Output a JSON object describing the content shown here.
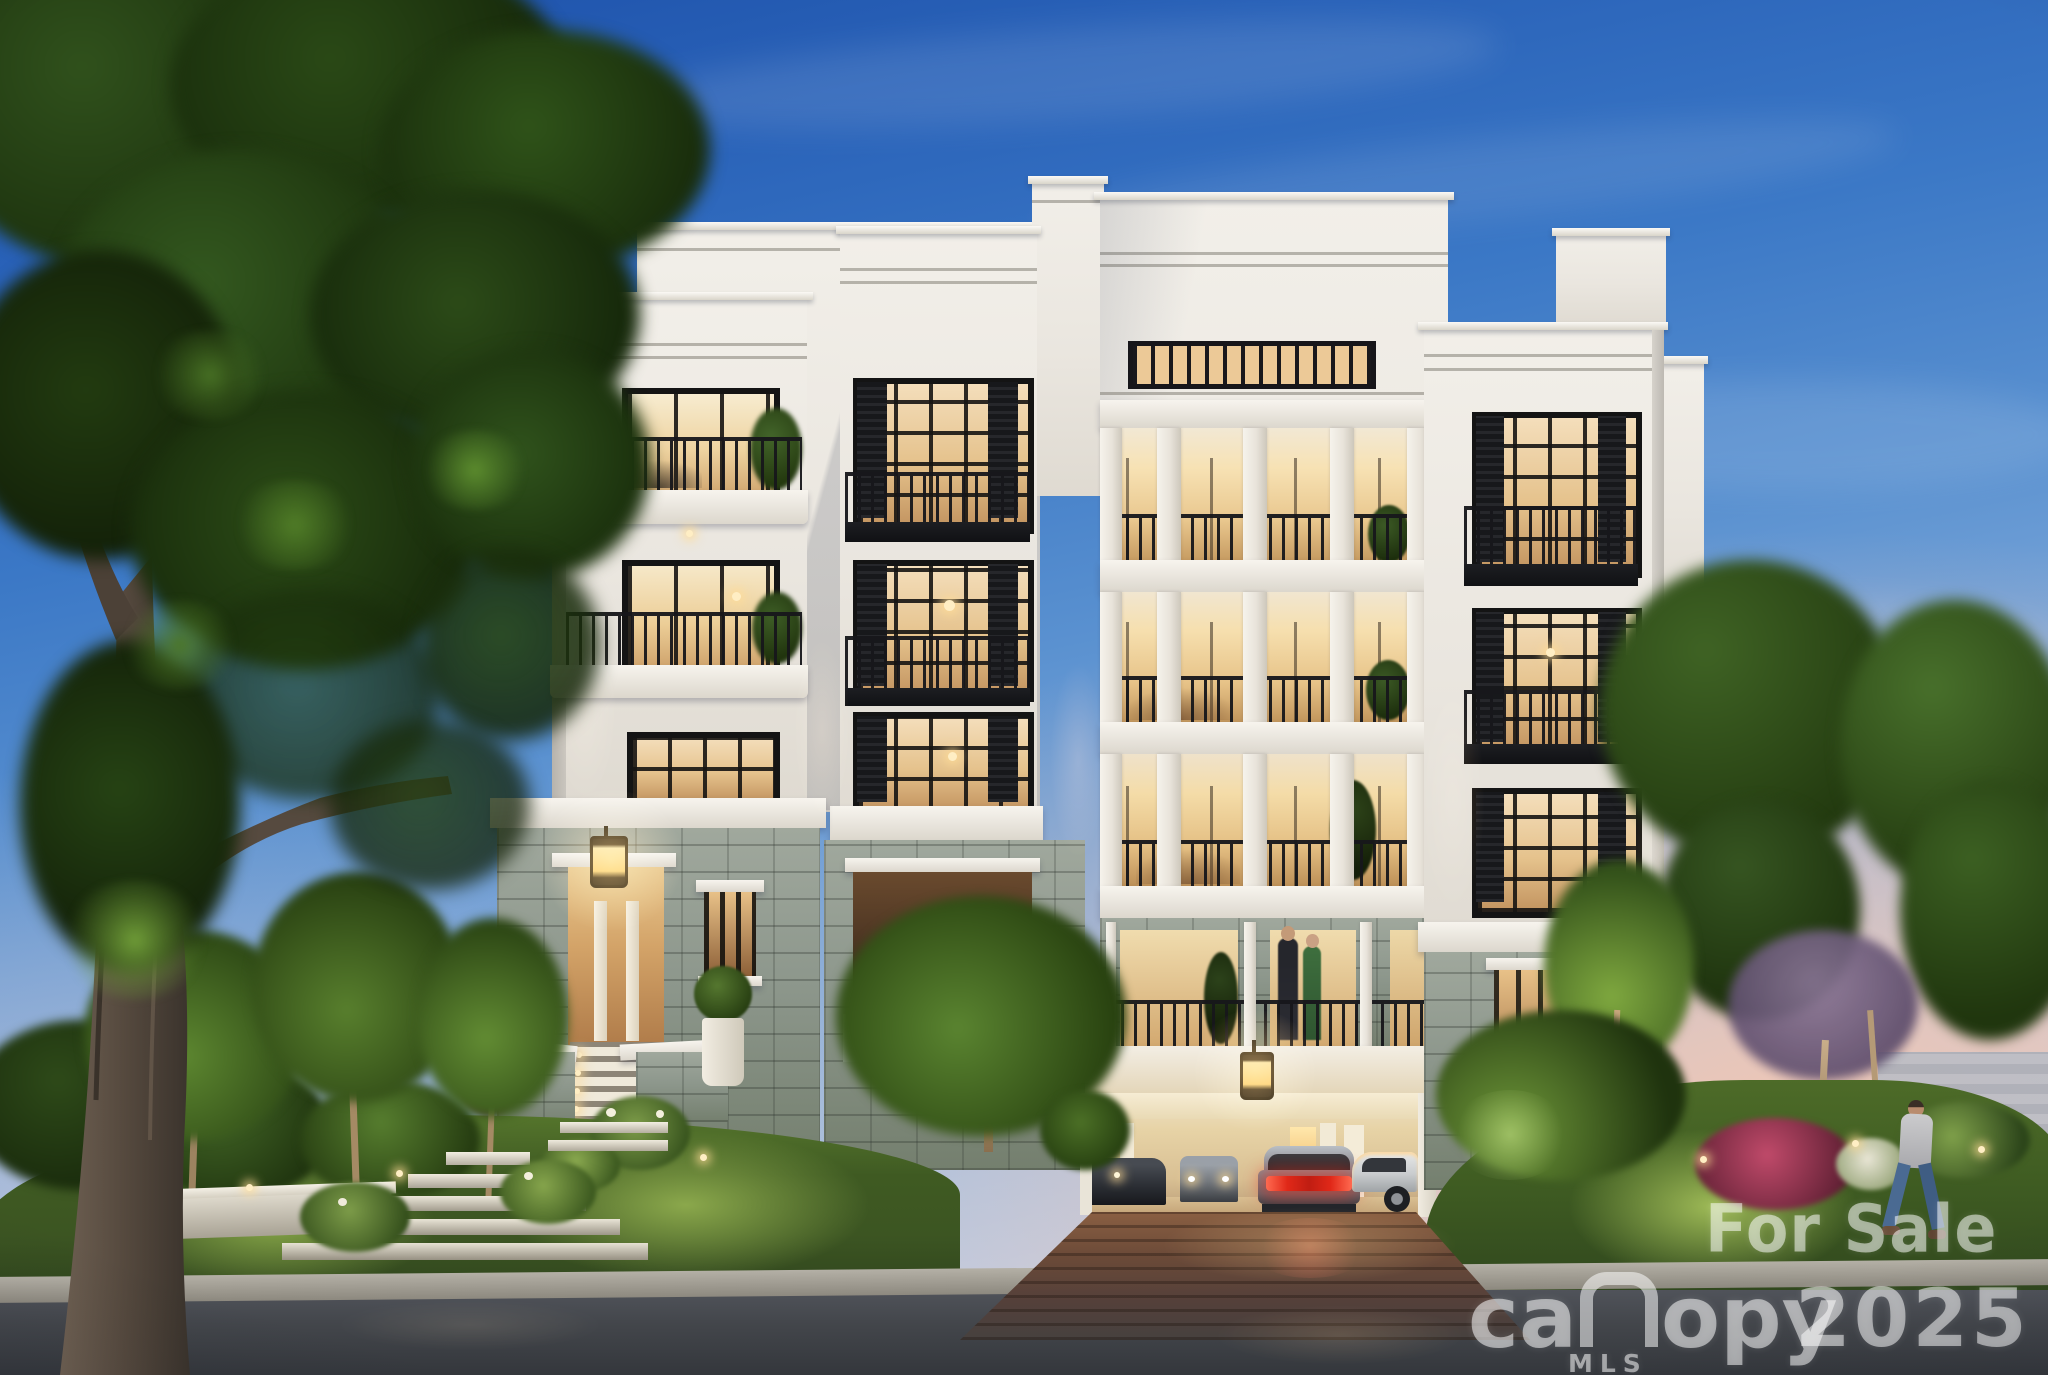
{
  "image": {
    "kind": "real-estate architectural rendering",
    "subject": "five-story white luxury condominium building at dusk with lit interiors",
    "orientation": "landscape"
  },
  "watermark": {
    "for_sale": "For Sale",
    "year": "2025",
    "brand": "canopy",
    "brand_prefix": "ca",
    "brand_suffix": "opy",
    "mls": "MLS",
    "text_color": "#ffffff"
  },
  "palette": {
    "sky_top": "#1c4fa8",
    "sky_mid": "#5a91d0",
    "sky_horizon_pink": "#e8c4b0",
    "building_white": "#ece8e1",
    "stone_base": "#8d978c",
    "window_glow": "#eecf97",
    "railing_black": "#17171b",
    "grass_lit": "#7f9f3c",
    "grass_dark": "#3c5522",
    "road_asphalt": "#43464b",
    "driveway_pavers": "#5c4336",
    "tree_dark": "#223d12",
    "tree_light": "#5c8f33",
    "taillight_red": "#e03a2e"
  },
  "scene": {
    "building": {
      "floors_visible": 5,
      "sections": [
        "left tower with two balconies",
        "center column of black shuttered windows",
        "central colonnade galleries with white columns",
        "stone level with railed openings",
        "right tower with juliet balconies"
      ],
      "base": "gray stone with parking garage opening",
      "lighting": "warm interior lights and landscape uplights"
    },
    "garage": {
      "cars_visible": 4,
      "center_car": "sedan with red taillights lit",
      "lantern": "lit carriage lantern above entry"
    },
    "entrance": {
      "feature": "stone portico with lit lantern, columns and staircase with step lights"
    },
    "landscape": {
      "left": "large mature tree, small trees, garden steps, magenta bush",
      "right": "lawn, azalea bushes, purple blossom tree, man walking"
    },
    "people_visible": 3
  }
}
